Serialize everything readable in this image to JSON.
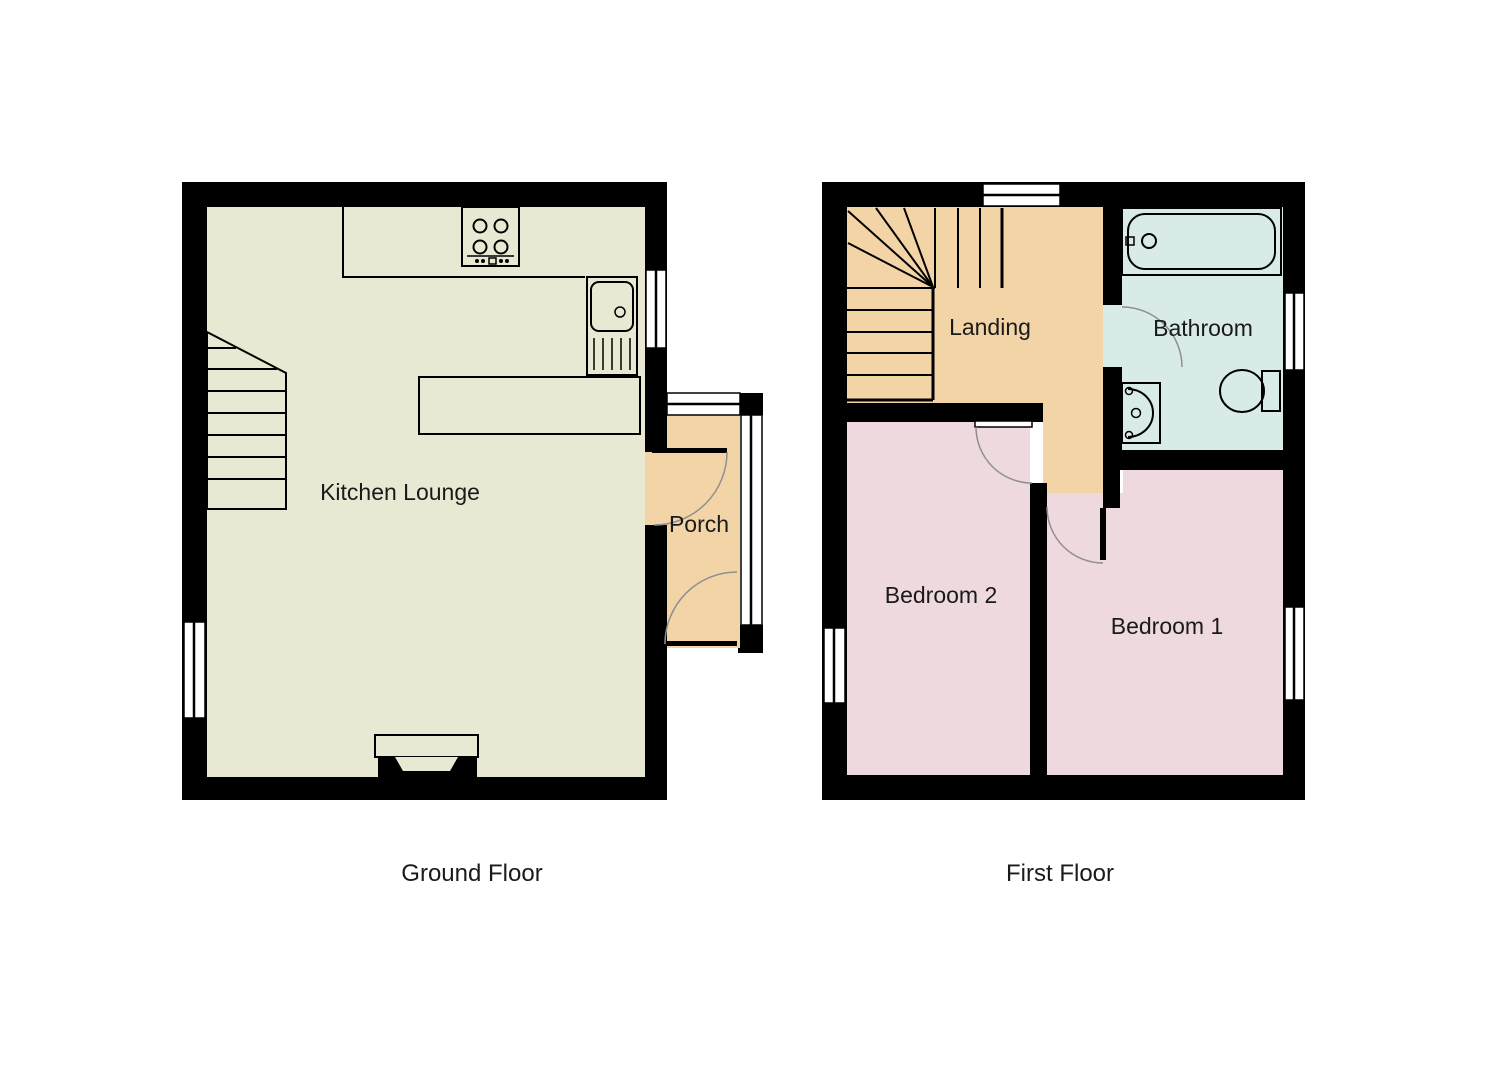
{
  "colors": {
    "wall": "#000000",
    "kitchen_lounge_floor": "#e9e9d3",
    "porch_floor": "#f3d4a6",
    "landing_floor": "#f3d4a6",
    "bedroom_floor": "#edd9de",
    "bathroom_floor": "#d9ebe8",
    "window_glass": "#ffffff",
    "door_swing": "#8f8f8f",
    "label_text": "#1a1a1a"
  },
  "ground_floor": {
    "caption": "Ground Floor",
    "rooms": {
      "kitchen_lounge": "Kitchen Lounge",
      "porch": "Porch"
    },
    "fixtures": [
      "staircase",
      "cooktop-hob",
      "kitchen-counter",
      "sink-with-drainer",
      "chimney-breast"
    ]
  },
  "first_floor": {
    "caption": "First Floor",
    "rooms": {
      "landing": "Landing",
      "bathroom": "Bathroom",
      "bedroom1": "Bedroom 1",
      "bedroom2": "Bedroom 2"
    },
    "fixtures": [
      "winder-staircase",
      "bathtub",
      "hand-basin",
      "toilet"
    ]
  }
}
